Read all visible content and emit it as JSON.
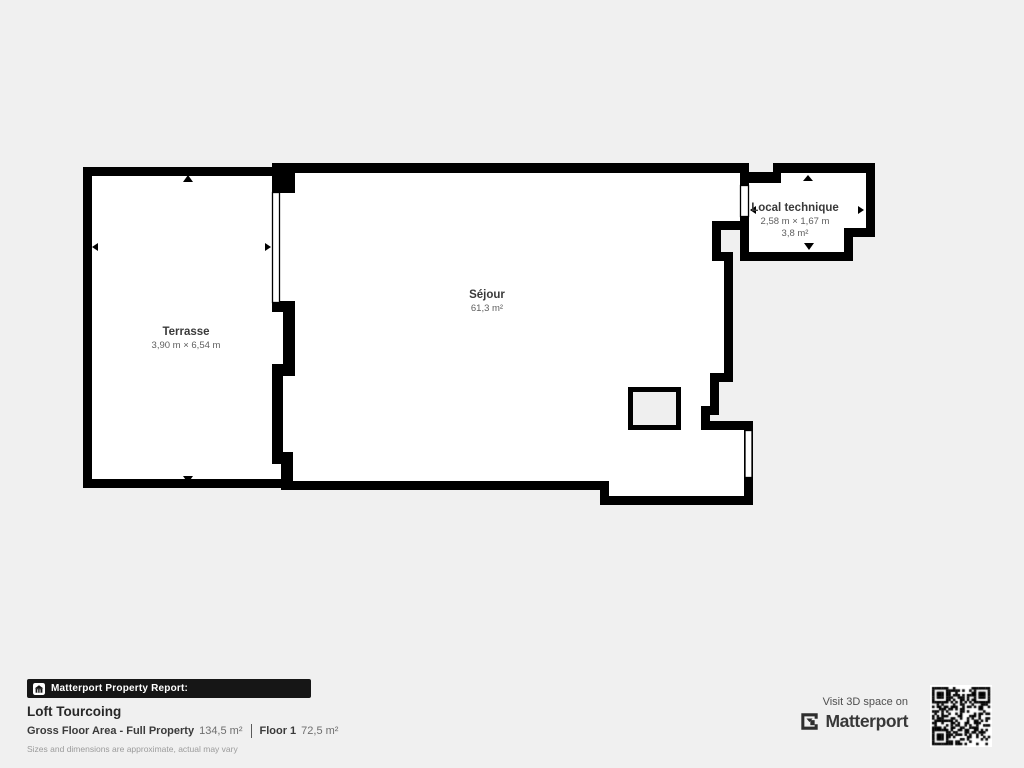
{
  "page": {
    "background_color": "#f0f0f0",
    "wall_color": "#000000",
    "room_fill_color": "#ffffff"
  },
  "plan": {
    "rooms": [
      {
        "id": "terrasse",
        "name": "Terrasse",
        "dims": "3,90 m × 6,54 m"
      },
      {
        "id": "sejour",
        "name": "Séjour",
        "area": "61,3 m²"
      },
      {
        "id": "local-technique",
        "name": "Local technique",
        "dims": "2,58 m × 1,67 m",
        "area": "3,8 m²"
      }
    ]
  },
  "footer": {
    "report_bar": "Matterport Property Report:",
    "title": "Loft Tourcoing",
    "gfa_label": "Gross Floor Area - Full Property",
    "gfa_value": "134,5 m²",
    "floor_label": "Floor 1",
    "floor_value": "72,5 m²",
    "disclaimer": "Sizes and dimensions are approximate, actual may vary"
  },
  "cta": {
    "visit_text": "Visit 3D space on",
    "brand": "Matterport"
  },
  "icons": {
    "report_bar_icon": "house-icon",
    "brand_icon": "matterport-m-icon",
    "qr": "qr-code"
  }
}
